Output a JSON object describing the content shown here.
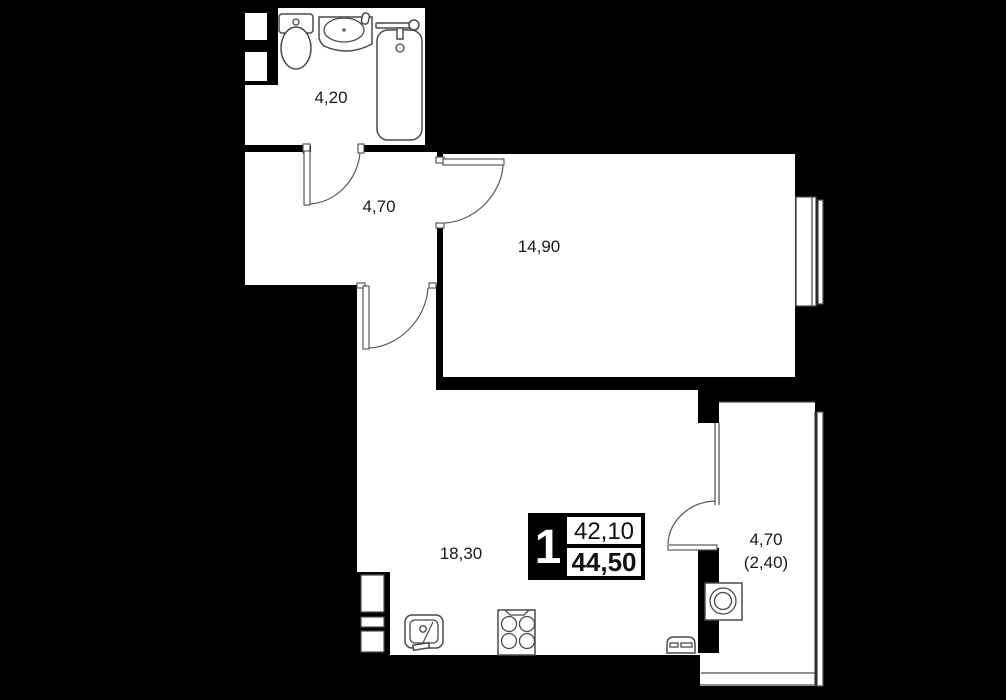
{
  "plan_title": "apartment-floor-plan",
  "badge": {
    "rooms_count": "1",
    "area_top": "42,10",
    "area_bottom": "44,50"
  },
  "rooms": {
    "bathroom": {
      "label": "4,20"
    },
    "hallway": {
      "label": "4,70"
    },
    "bedroom": {
      "label": "14,90"
    },
    "living_kitchen": {
      "label": "18,30"
    },
    "balcony": {
      "label": "4,70",
      "label_secondary": "(2,40)"
    }
  },
  "fixtures": [
    "toilet",
    "bathroom-sink",
    "bathtub",
    "ventilation-shaft",
    "kitchen-sink",
    "stove",
    "oven",
    "washing-machine"
  ],
  "colors": {
    "background": "#000000",
    "room_fill": "#ffffff",
    "line": "#4a4a4a",
    "text": "#1a1a1a"
  }
}
